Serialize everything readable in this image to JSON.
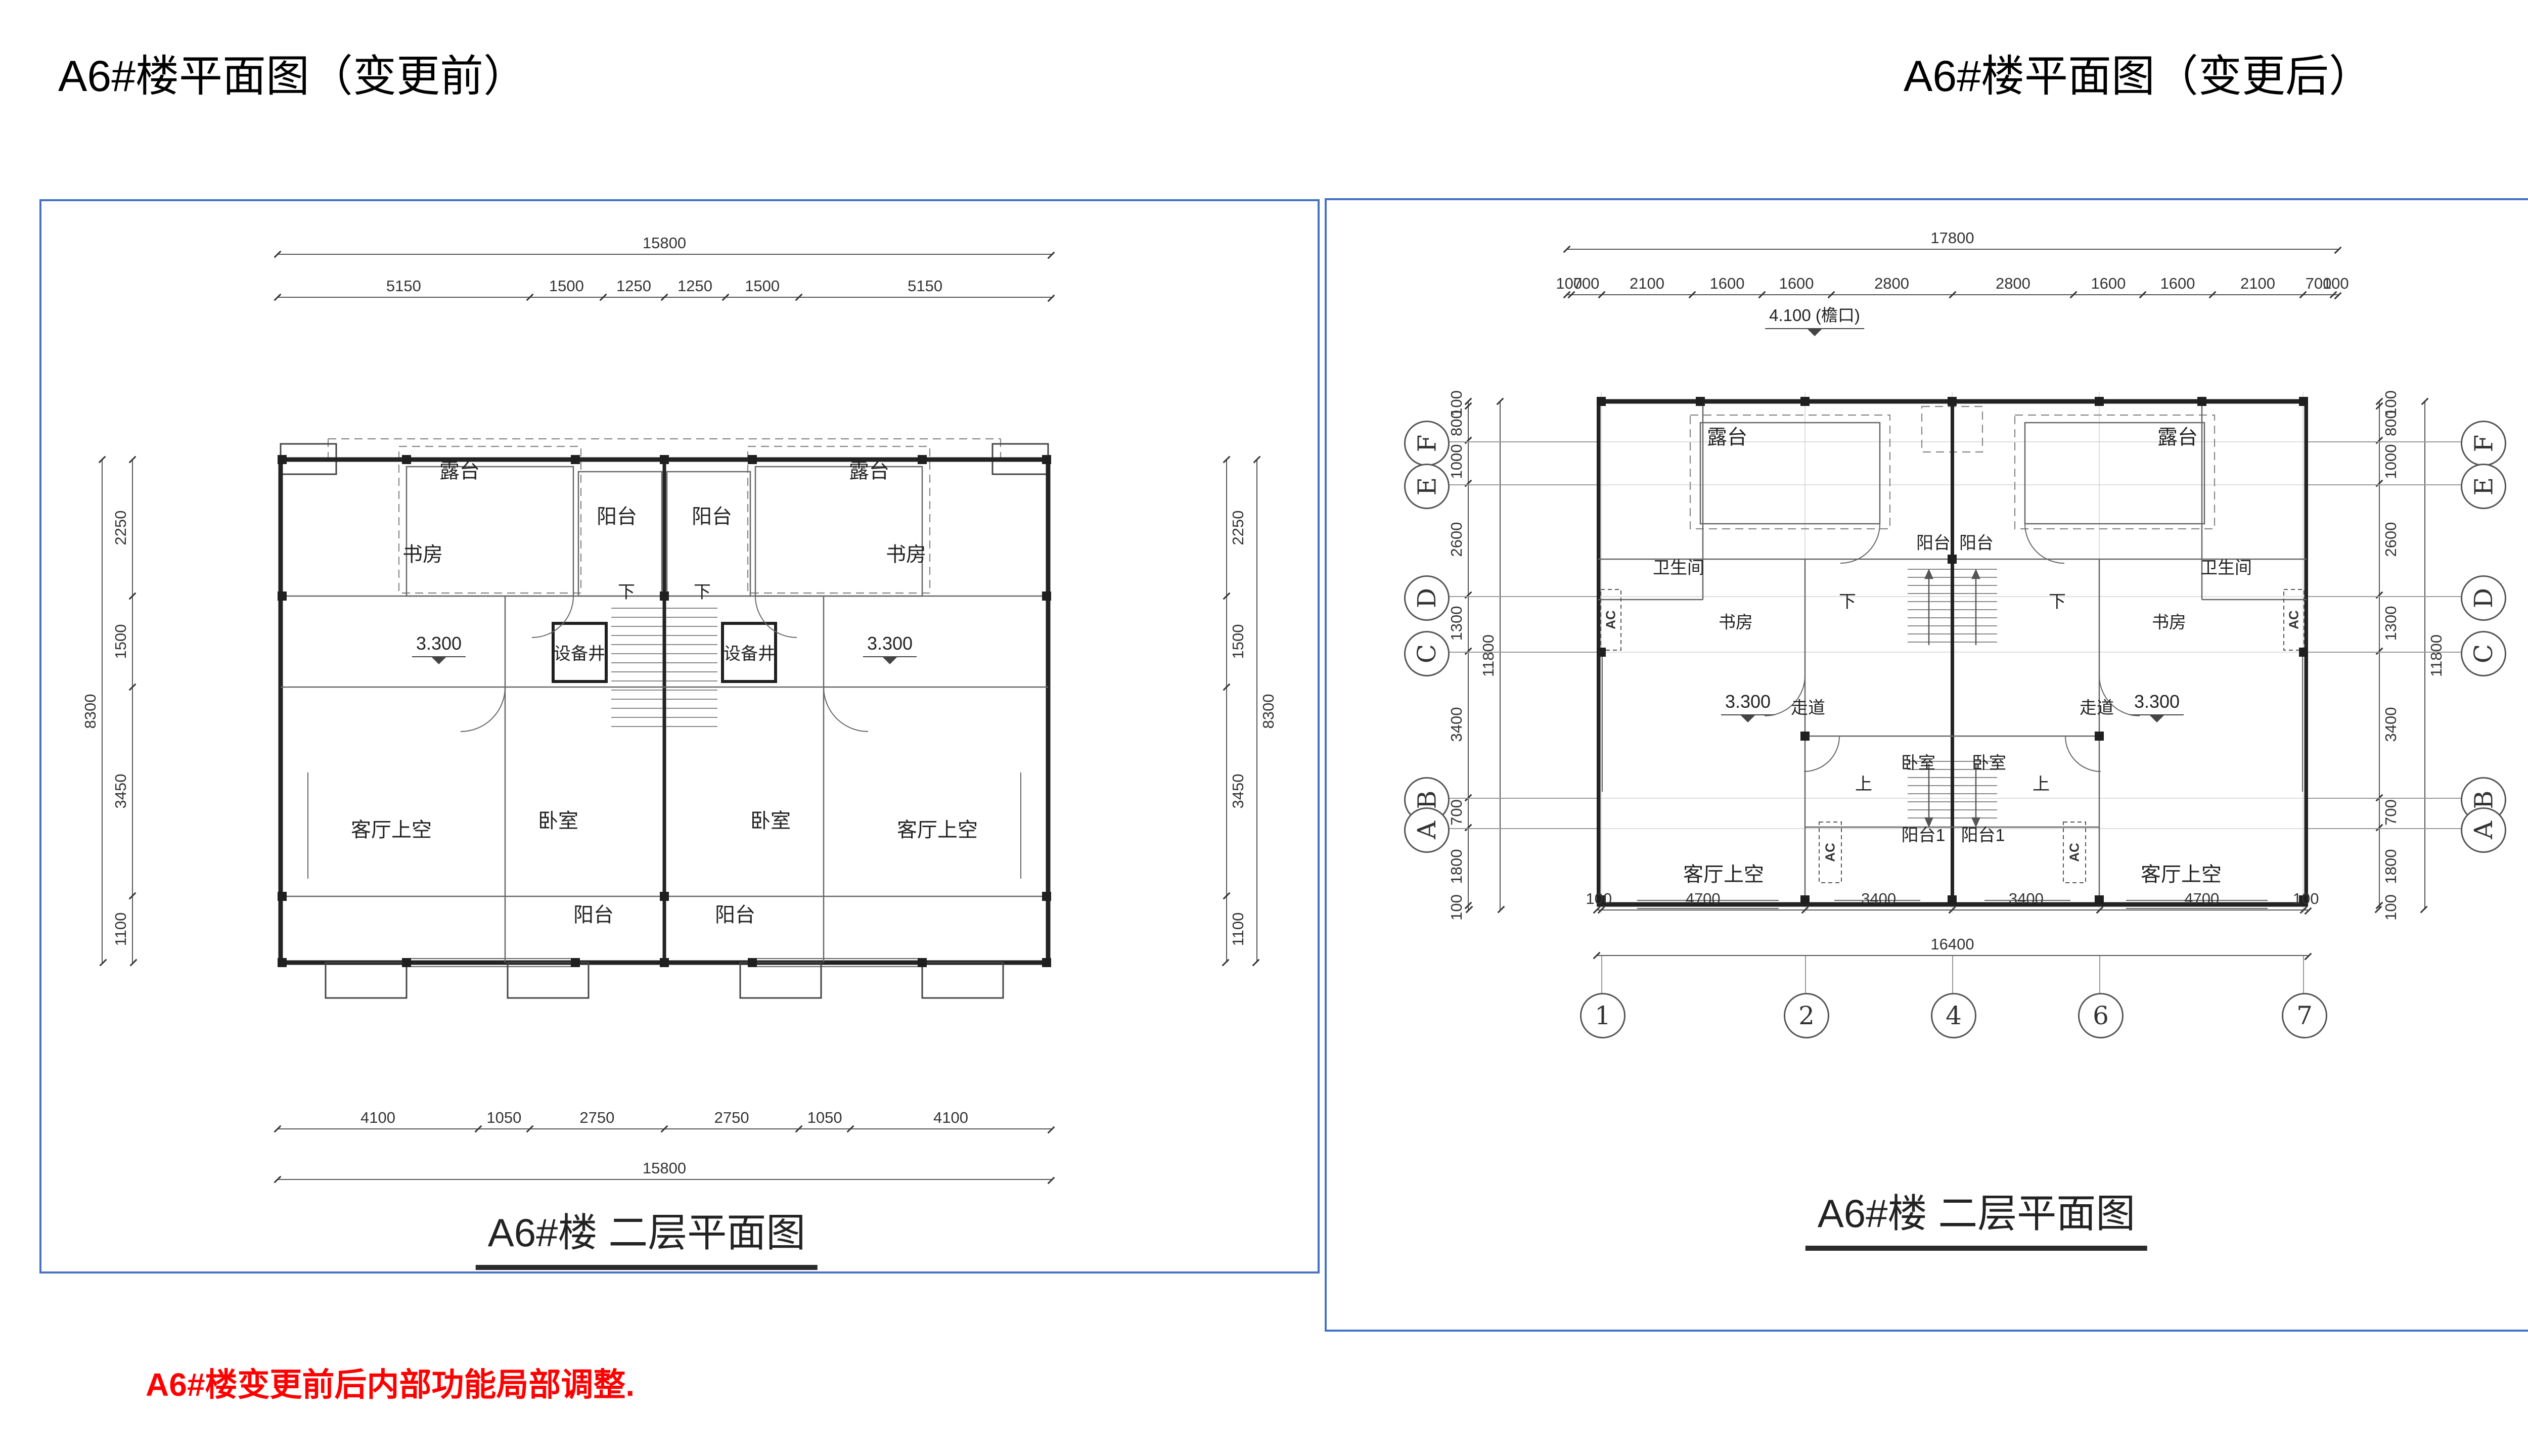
{
  "page": {
    "title_before": "A6#楼平面图（变更前）",
    "title_after": "A6#楼平面图（变更后）",
    "note": "A6#楼变更前后内部功能局部调整.",
    "accent_border": "#4472c4",
    "note_color": "#ff0000"
  },
  "plan_before": {
    "caption": "A6#楼 二层平面图",
    "dims": {
      "top_overall": "15800",
      "top": [
        "5150",
        "1500",
        "1250",
        "1250",
        "1500",
        "5150"
      ],
      "bottom": [
        "4100",
        "1050",
        "2750",
        "2750",
        "1050",
        "4100"
      ],
      "bottom_overall": "15800",
      "side": [
        "2250",
        "1500",
        "3450",
        "1100"
      ],
      "side_overall": "8300"
    },
    "labels": {
      "terrace": "露台",
      "balcony": "阳台",
      "study": "书房",
      "shaft": "设备井",
      "level": "3.300",
      "living_void": "客厅上空",
      "bedroom": "卧室",
      "down": "下"
    }
  },
  "plan_after": {
    "caption": "A6#楼 二层平面图",
    "eave_note": "4.100 (檐口)",
    "dims": {
      "top_overall": "17800",
      "top": [
        "100",
        "700",
        "2100",
        "1600",
        "1600",
        "2800",
        "2800",
        "1600",
        "1600",
        "2100",
        "700",
        "100"
      ],
      "bottom": [
        "100",
        "4700",
        "3400",
        "3400",
        "4700",
        "100"
      ],
      "bottom_overall": "16400",
      "side": [
        "100",
        "800",
        "1000",
        "2600",
        "1300",
        "3400",
        "700",
        "1800",
        "100"
      ],
      "side_overall": "11800"
    },
    "axes": {
      "letters": [
        "F",
        "E",
        "D",
        "C",
        "B",
        "A"
      ],
      "numbers": [
        "1",
        "2",
        "4",
        "6",
        "7"
      ]
    },
    "labels": {
      "terrace": "露台",
      "bath": "卫生间",
      "study": "书房",
      "corridor": "走道",
      "level": "3.300",
      "balcony": "阳台",
      "balcony1": "阳台1",
      "bedroom": "卧室",
      "living_void": "客厅上空",
      "down": "下",
      "up": "上",
      "ac": "AC"
    }
  }
}
